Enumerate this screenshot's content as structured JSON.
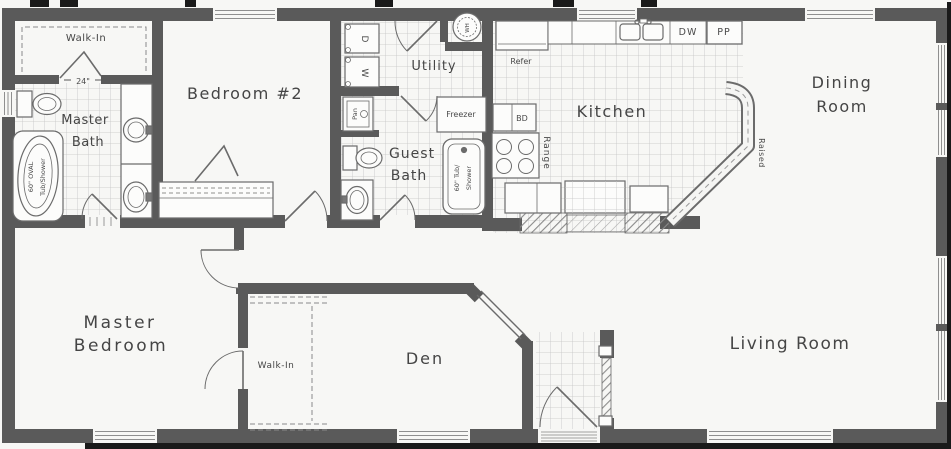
{
  "colors": {
    "paper": "#f7f7f5",
    "wall": "#5a5a5a",
    "fixture_line": "#6b6b6b",
    "tile_line": "#c4c4c4",
    "text": "#474747",
    "scan_artifact": "#1a1a1a"
  },
  "rooms": {
    "walk_in_top": {
      "label": "Walk-In"
    },
    "master_bath": {
      "line1": "Master",
      "line2": "Bath"
    },
    "bedroom2": {
      "label": "Bedroom #2"
    },
    "utility": {
      "label": "Utility"
    },
    "guest_bath": {
      "line1": "Guest",
      "line2": "Bath"
    },
    "kitchen": {
      "label": "Kitchen"
    },
    "dining_room": {
      "line1": "Dining",
      "line2": "Room"
    },
    "master_bedroom": {
      "line1": "Master",
      "line2": "Bedroom"
    },
    "walk_in_bottom": {
      "label": "Walk-In"
    },
    "den": {
      "label": "Den"
    },
    "living_room": {
      "label": "Living Room"
    }
  },
  "fixtures": {
    "master_tub_line1": "60\" OVAL",
    "master_tub_line2": "Tub/Shower",
    "guest_tub_line1": "60\" Tub/",
    "guest_tub_line2": "Shower",
    "refrigerator": "Refer",
    "freezer": "Freezer",
    "range": "Range",
    "raised_counter": "Raised",
    "dishwasher": "DW",
    "pantry": "PP",
    "cabinet_bd": "BD",
    "dryer": "D",
    "washer": "W",
    "water_heater": "WH",
    "pan_cabinet": "Pan",
    "closet_dim": "24\""
  }
}
